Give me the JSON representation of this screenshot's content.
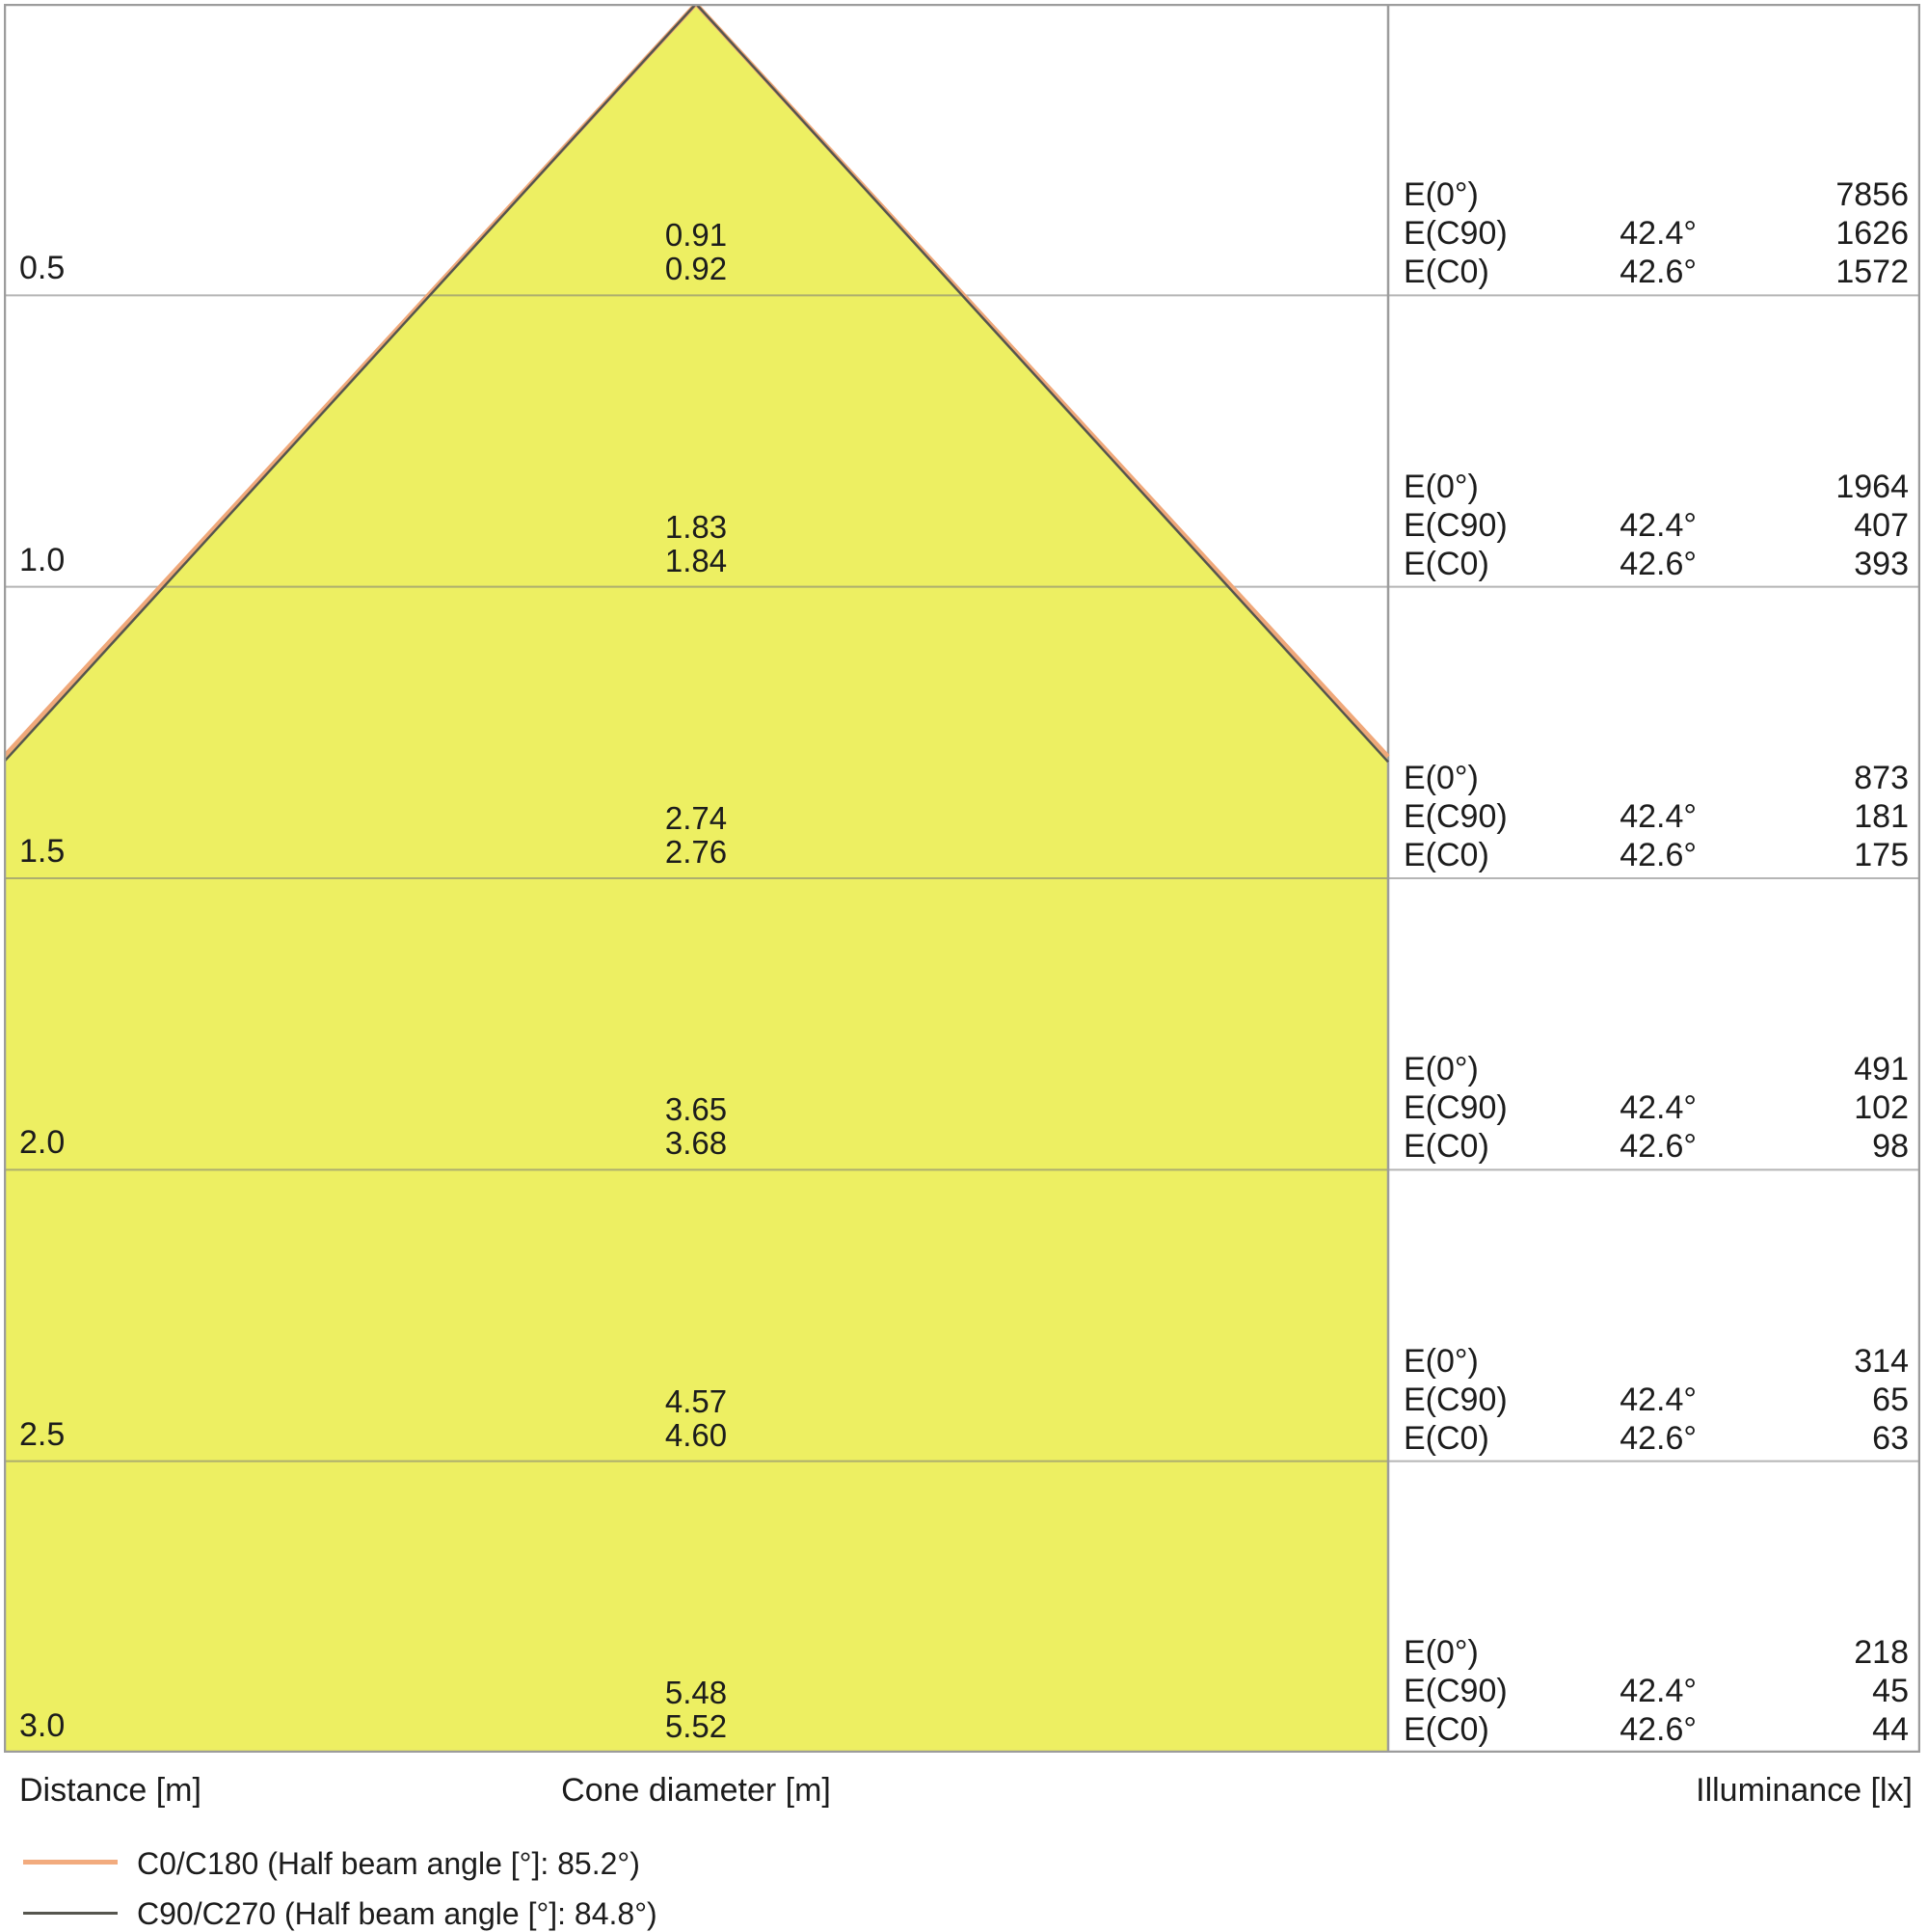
{
  "chart_data": {
    "type": "area",
    "subtype": "luminaire-light-cone-diagram",
    "axis_labels": {
      "distance": "Distance [m]",
      "cone_diameter": "Cone diameter [m]",
      "illuminance": "Illuminance [lx]"
    },
    "distance_axis_m": [
      0.5,
      1.0,
      1.5,
      2.0,
      2.5,
      3.0
    ],
    "rows": [
      {
        "distance_label": "0.5",
        "cone_diameters_m": [
          "0.91",
          "0.92"
        ],
        "illuminance": [
          {
            "label": "E(0°)",
            "angle": "",
            "value": "7856"
          },
          {
            "label": "E(C90)",
            "angle": "42.4°",
            "value": "1626"
          },
          {
            "label": "E(C0)",
            "angle": "42.6°",
            "value": "1572"
          }
        ]
      },
      {
        "distance_label": "1.0",
        "cone_diameters_m": [
          "1.83",
          "1.84"
        ],
        "illuminance": [
          {
            "label": "E(0°)",
            "angle": "",
            "value": "1964"
          },
          {
            "label": "E(C90)",
            "angle": "42.4°",
            "value": "407"
          },
          {
            "label": "E(C0)",
            "angle": "42.6°",
            "value": "393"
          }
        ]
      },
      {
        "distance_label": "1.5",
        "cone_diameters_m": [
          "2.74",
          "2.76"
        ],
        "illuminance": [
          {
            "label": "E(0°)",
            "angle": "",
            "value": "873"
          },
          {
            "label": "E(C90)",
            "angle": "42.4°",
            "value": "181"
          },
          {
            "label": "E(C0)",
            "angle": "42.6°",
            "value": "175"
          }
        ]
      },
      {
        "distance_label": "2.0",
        "cone_diameters_m": [
          "3.65",
          "3.68"
        ],
        "illuminance": [
          {
            "label": "E(0°)",
            "angle": "",
            "value": "491"
          },
          {
            "label": "E(C90)",
            "angle": "42.4°",
            "value": "102"
          },
          {
            "label": "E(C0)",
            "angle": "42.6°",
            "value": "98"
          }
        ]
      },
      {
        "distance_label": "2.5",
        "cone_diameters_m": [
          "4.57",
          "4.60"
        ],
        "illuminance": [
          {
            "label": "E(0°)",
            "angle": "",
            "value": "314"
          },
          {
            "label": "E(C90)",
            "angle": "42.4°",
            "value": "65"
          },
          {
            "label": "E(C0)",
            "angle": "42.6°",
            "value": "63"
          }
        ]
      },
      {
        "distance_label": "3.0",
        "cone_diameters_m": [
          "5.48",
          "5.52"
        ],
        "illuminance": [
          {
            "label": "E(0°)",
            "angle": "",
            "value": "218"
          },
          {
            "label": "E(C90)",
            "angle": "42.4°",
            "value": "45"
          },
          {
            "label": "E(C0)",
            "angle": "42.6°",
            "value": "44"
          }
        ]
      }
    ],
    "legend": [
      {
        "label": "C0/C180 (Half beam angle [°]: 85.2°)",
        "color": "#f2ab7e"
      },
      {
        "label": "C90/C270 (Half beam angle [°]: 84.8°)",
        "color": "#55554e"
      }
    ],
    "beam": {
      "half_beam_angle_c0_deg": 42.6,
      "half_beam_angle_c90_deg": 42.4
    },
    "colors": {
      "cone_fill": "#edef62",
      "c0_line": "#f0a87a",
      "c90_line": "#55554e",
      "grid": "rgba(120,120,120,0.55)",
      "border": "#9c9c9c",
      "text": "#1c1c1c"
    },
    "layout": {
      "legend_position": "bottom-left",
      "grid": "horizontal-rows"
    }
  }
}
